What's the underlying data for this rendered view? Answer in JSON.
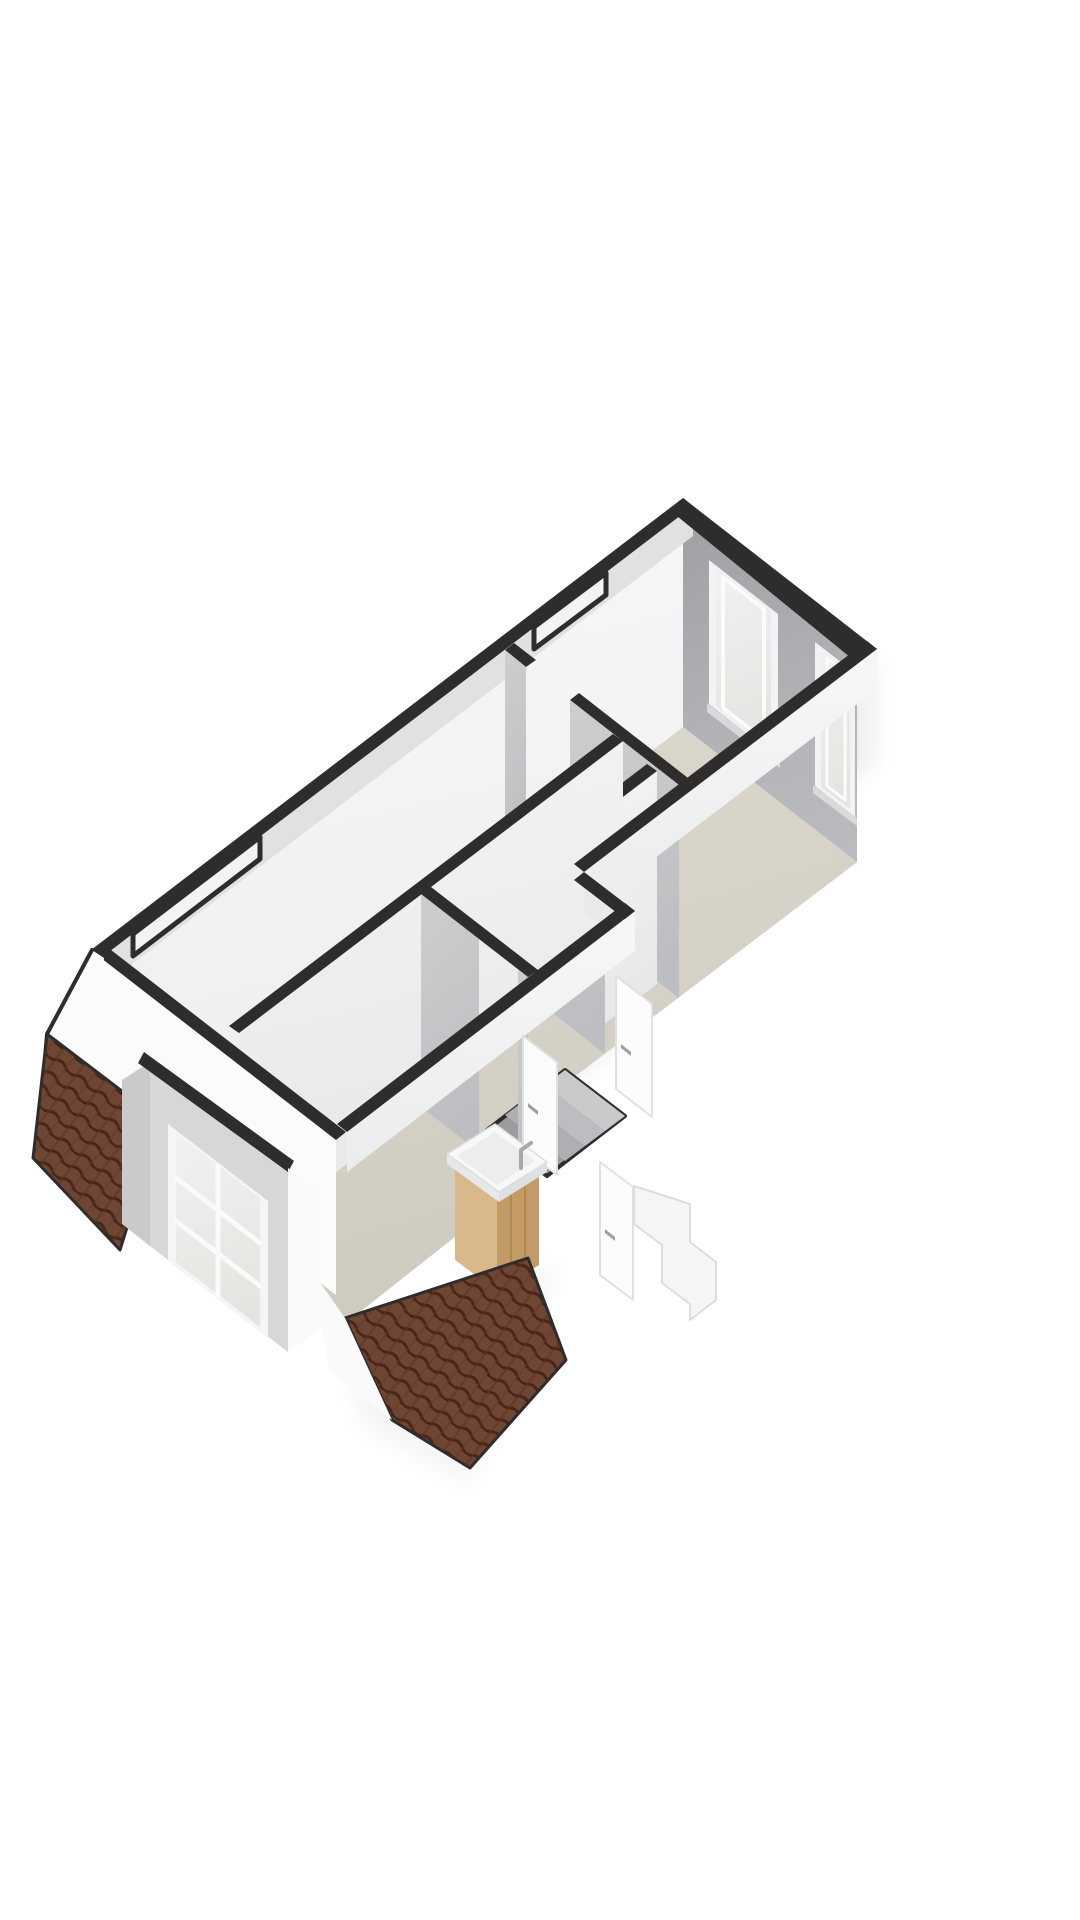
{
  "meta": {
    "kind": "3d-floorplan-render",
    "view": "isometric-top",
    "storey": "attic-floor",
    "background": "#ffffff"
  },
  "palette": {
    "wall_cap_dark": "#2e2d2b",
    "wall_inner_shaded": "#a8a9ad",
    "wall_inner_lit": "#f6f6f7",
    "wall_interior_gray": "#c7c8ca",
    "floor_beige": "#d6d2c8",
    "roof_tile_brown": "#6f4533",
    "roof_tile_shadow": "#47261a",
    "glass": "#eceeec",
    "frame_white": "#f4f5f6",
    "vanity_wood_light": "#d9b98c",
    "vanity_wood_dark": "#c49a66",
    "basin_white": "#f7f8f8",
    "shadow": "#000000"
  },
  "features": [
    "perimeter-wall-caps",
    "ne-wall-window-large",
    "ne-wall-window-small",
    "roof-slit-window-upper",
    "roof-slit-window-lower",
    "dormer-window",
    "roof-slope-left",
    "roof-slope-bottom",
    "interior-partition-walls",
    "stair-void",
    "exterior-stair-silhouette",
    "interior-door-1",
    "interior-door-2",
    "interior-door-3",
    "bathroom-vanity-sink",
    "gable-wall"
  ],
  "elements": [
    {
      "n": "shadow-se-upper",
      "p": "877,655 588,878 588,985 877,762",
      "f": "#000000",
      "o": 0.06,
      "flt": "url(#soft)"
    },
    {
      "n": "shadow-se-lower",
      "p": "633,916 350,1136 350,1255 633,1035",
      "f": "#000000",
      "o": 0.06,
      "flt": "url(#soft)"
    },
    {
      "n": "shadow-sw",
      "p": "100,962 338,1146 338,1240 100,1056",
      "f": "#000000",
      "o": 0.045,
      "flt": "url(#soft)"
    },
    {
      "n": "shadow-tip",
      "p": "345,1330 560,1262 470,1485 360,1425",
      "f": "#000000",
      "o": 0.04,
      "flt": "url(#soft)"
    },
    {
      "n": "ne-wall-inner-face",
      "p": "683,514 857,649 857,862 683,727",
      "f": "url(#gNE)"
    },
    {
      "n": "east-end-wall-inner-face",
      "p": "857,649 574,864 574,1077 857,862",
      "f": "url(#gEE)"
    },
    {
      "n": "window-large-frame",
      "p": "709,560 778,614 778,758 709,704",
      "f": "#f2f3f4"
    },
    {
      "n": "window-large-glass",
      "p": "716,567 771,610 771,749 716,706",
      "f": "url(#gGlass)"
    },
    {
      "n": "window-large-inner-frame",
      "p": "723,577 764,609 764,740 723,708",
      "f": "none",
      "s": "#fafbfb",
      "w": 4
    },
    {
      "n": "window-large-sill",
      "p": "707,703 780,759 780,768 707,712",
      "f": "#d8d9db"
    },
    {
      "n": "window-small-frame",
      "p": "815,642 855,673 855,817 815,786",
      "f": "#f2f3f4"
    },
    {
      "n": "window-small-glass",
      "p": "821,649 850,671 850,809 821,787",
      "f": "url(#gGlass)"
    },
    {
      "n": "window-small-inner-frame",
      "p": "827,658 845,672 845,800 827,786",
      "f": "none",
      "s": "#fafbfb",
      "w": 3
    },
    {
      "n": "window-small-sill",
      "p": "813,785 857,818 857,826 813,793",
      "f": "#d8d9db"
    },
    {
      "n": "floor-slab",
      "p": "683,727 857,862 574,1077 616,1110 337,1330 112,1163",
      "f": "url(#gFloor)"
    },
    {
      "n": "nw-wall-inner-face",
      "p": "683,514 112,950 112,1163 683,727",
      "f": "url(#gNW)"
    },
    {
      "n": "nw-wall-slope-band",
      "p": "693,506 101,958 101,988 693,536",
      "f": "#e0e1e3"
    },
    {
      "n": "partition-w1-cap-a",
      "p": "514,643 536,660 526,667 505,650",
      "f": "#2e2d2b"
    },
    {
      "n": "partition-w1-face-a",
      "p": "505,650 526,667 526,880 505,863",
      "f": "url(#gWB)"
    },
    {
      "n": "partition-w1-cap-b",
      "p": "579,693 688,778 679,785 570,700",
      "f": "#2e2d2b"
    },
    {
      "n": "partition-w1-face-b",
      "p": "570,700 679,785 679,998 570,913",
      "f": "url(#gWB)"
    },
    {
      "n": "closet-divider-face",
      "p": "657,771 586,825 586,1038 657,984",
      "f": "url(#gWA)"
    },
    {
      "n": "closet-divider-cap",
      "p": "647,764 576,818 586,825 657,771",
      "f": "#2e2d2b"
    },
    {
      "n": "closet-front-face",
      "p": "549,797 605,841 605,1054 549,1010",
      "f": "url(#gWB)"
    },
    {
      "n": "closet-front-cap",
      "p": "558,790 614,834 605,841 549,797",
      "f": "#2e2d2b"
    },
    {
      "n": "partition-w2-face",
      "p": "623,741 239,1033 239,1246 623,954",
      "f": "url(#gWA)"
    },
    {
      "n": "partition-w2-cap",
      "p": "613,734 229,1026 239,1033 623,741",
      "f": "#2e2d2b"
    },
    {
      "n": "stair-void",
      "p": "565,1070 625,1116 547,1176 487,1130",
      "f": "#9b9c9f",
      "s": "#2e2d2b",
      "w": 4
    },
    {
      "n": "stair-void-tread-1",
      "p": "565,1070 625,1116 605,1131 545,1085",
      "f": "#c9cacc"
    },
    {
      "n": "stair-void-tread-2",
      "p": "545,1085 605,1131 585,1146 525,1100",
      "f": "#bcbdc0"
    },
    {
      "n": "stair-void-tread-3",
      "p": "525,1100 585,1146 565,1161 505,1115",
      "f": "#aeafb2"
    },
    {
      "n": "bathroom-wall-face-a",
      "p": "421,894 479,939 479,1152 421,1107",
      "f": "url(#gWB)"
    },
    {
      "n": "bathroom-wall-face-b",
      "p": "518,970 528,977 528,1190 518,1183",
      "f": "url(#gWB)"
    },
    {
      "n": "bathroom-wall-cap",
      "p": "431,887 538,970 528,977 421,894",
      "f": "#2e2d2b"
    },
    {
      "n": "exterior-band-se-upper",
      "p": "877,649 584,872 584,912 877,689",
      "f": "url(#gBand)"
    },
    {
      "n": "exterior-band-step",
      "p": "584,872 635,911 635,951 584,912",
      "f": "#e8e9eb"
    },
    {
      "n": "exterior-band-se-lower",
      "p": "635,911 347,1132 347,1172 635,951",
      "f": "url(#gBand)"
    },
    {
      "n": "exterior-band-sw",
      "p": "101,958 336,1140 336,1295 101,1113",
      "f": "#fbfbfc"
    },
    {
      "n": "exterior-staircase-silhouette",
      "p": "634,1186 634,1224 662,1245 662,1283 690,1304 690,1320 716,1300 716,1262 690,1242 690,1204",
      "f": "#f5f5f7",
      "s": "#dcddde",
      "w": 2
    },
    {
      "n": "door-leaf-1",
      "p": "616,976 652,1004 652,1117 616,1089",
      "f": "#fcfcfd",
      "s": "#e0e1e3",
      "w": 2
    },
    {
      "n": "door-leaf-1-handle",
      "p": "621,1044 631,1052 631,1056 621,1048",
      "f": "#9fa0a3"
    },
    {
      "n": "door-leaf-2",
      "p": "523,1036 557,1062 557,1175 523,1149",
      "f": "#fcfcfd",
      "s": "#e0e1e3",
      "w": 2
    },
    {
      "n": "door-leaf-2-handle",
      "p": "528,1103 538,1111 538,1115 528,1107",
      "f": "#9fa0a3"
    },
    {
      "n": "door-leaf-3",
      "p": "600,1162 633,1187 633,1300 600,1275",
      "f": "#fcfcfd",
      "s": "#e0e1e3",
      "w": 2
    },
    {
      "n": "door-leaf-3-handle",
      "p": "605,1229 615,1237 615,1241 605,1233",
      "f": "#9fa0a3"
    },
    {
      "n": "cap-ne-wall",
      "p": "683,498 877,649 856,662 672,512",
      "f": "#2e2d2b"
    },
    {
      "n": "cap-east-end-wall",
      "p": "877,649 584,872 574,864 867,641",
      "f": "#2e2d2b"
    },
    {
      "n": "cap-step-wall",
      "p": "584,872 635,911 625,919 574,880",
      "f": "#2e2d2b"
    },
    {
      "n": "cap-se-lower-wall",
      "p": "635,911 347,1132 337,1124 625,903",
      "f": "#2e2d2b"
    },
    {
      "n": "cap-sw-knee-wall",
      "p": "101,958 336,1140 346,1132 111,950",
      "f": "#2e2d2b"
    },
    {
      "n": "cap-nw-wall",
      "p": "683,498 91,950 101,958 693,506",
      "f": "#2e2d2b"
    },
    {
      "n": "roof-slit-window-upper",
      "p": "606,573 534,627 534,649 606,595",
      "f": "#f2f3f3",
      "s": "#2e2d2b",
      "w": 5
    },
    {
      "n": "roof-slit-window-lower",
      "p": "260,837 133,934 133,956 260,859",
      "f": "#f2f3f3",
      "s": "#2e2d2b",
      "w": 5
    },
    {
      "n": "vanity-cabinet-left-face",
      "p": "455,1168 455,1260 497,1291 497,1199",
      "f": "#d9b98c"
    },
    {
      "n": "vanity-cabinet-right-face",
      "p": "497,1199 539,1173 539,1265 497,1291",
      "f": "#c49a66"
    },
    {
      "n": "vanity-plank-line-1",
      "t": "polyline",
      "p": "511,1191 511,1283",
      "f": "none",
      "s": "#b08a55",
      "w": 2
    },
    {
      "n": "vanity-plank-line-2",
      "t": "polyline",
      "p": "525,1182 525,1274",
      "f": "none",
      "s": "#b08a55",
      "w": 2
    },
    {
      "n": "vanity-basin-front-left",
      "p": "447,1154 447,1164 499,1202 499,1192",
      "f": "#e7e8e9"
    },
    {
      "n": "vanity-basin-front-right",
      "p": "499,1192 499,1202 547,1172 547,1162",
      "f": "#dfe0e1"
    },
    {
      "n": "vanity-basin-top",
      "p": "447,1154 499,1192 547,1162 495,1124",
      "f": "#f7f8f8",
      "s": "#dcddde",
      "w": 1.5
    },
    {
      "n": "vanity-basin-bowl",
      "p": "457,1156 497,1185 535,1161 495,1132",
      "f": "#eceded"
    },
    {
      "n": "vanity-faucet",
      "t": "path",
      "d": "M521,1168 L521,1150 L531,1143",
      "f": "none",
      "s": "#a7a8ab",
      "w": 4
    },
    {
      "n": "gable-wall-west",
      "p": "92,950 47,1034 38,1148 104,1096 104,958",
      "f": "#fcfcfd"
    },
    {
      "n": "gable-wall-west-edge",
      "t": "polyline",
      "p": "92,950 47,1034 38,1148",
      "f": "none",
      "s": "#2e2d2b",
      "w": 4
    },
    {
      "n": "roof-slope-left",
      "p": "47,1034 160,1120 120,1250 33,1158",
      "f": "url(#roofTiles)",
      "s": "#2e2d2b",
      "w": 3
    },
    {
      "n": "dormer-cheek",
      "p": "150,1062 150,1246 122,1224 122,1080",
      "f": "#c9cacc"
    },
    {
      "n": "dormer-face",
      "p": "150,1062 288,1168 288,1352 150,1246",
      "f": "#d6d7d9"
    },
    {
      "n": "dormer-cap",
      "p": "144,1052 294,1161 288,1172 138,1063",
      "f": "#2e2d2b"
    },
    {
      "n": "dormer-window-frame",
      "p": "168,1124 268,1201 268,1338 168,1261",
      "f": "#f4f5f6"
    },
    {
      "n": "dormer-window-glass",
      "p": "176,1133 260,1198 260,1327 176,1262",
      "f": "url(#gGlass)"
    },
    {
      "n": "dormer-window-mullion-v",
      "t": "polyline",
      "p": "218,1166 218,1295",
      "f": "none",
      "s": "#fafafa",
      "w": 5
    },
    {
      "n": "dormer-window-transom-1",
      "t": "polyline",
      "p": "176,1178 260,1243",
      "f": "none",
      "s": "#fafafa",
      "w": 5
    },
    {
      "n": "dormer-window-transom-2",
      "t": "polyline",
      "p": "176,1221 260,1286",
      "f": "none",
      "s": "#fafafa",
      "w": 5
    },
    {
      "n": "gable-sliver-right-of-dormer",
      "p": "288,1168 320,1192 320,1330 288,1352",
      "f": "#fafafb"
    },
    {
      "n": "roof-slope-bottom",
      "p": "345,1318 528,1258 566,1360 470,1468 392,1420",
      "f": "url(#roofTiles)",
      "s": "#2e2d2b",
      "w": 3
    },
    {
      "n": "gable-sliver-left-of-bottom-roof",
      "p": "310,1268 345,1318 392,1420 330,1372",
      "f": "#fafafb"
    }
  ]
}
